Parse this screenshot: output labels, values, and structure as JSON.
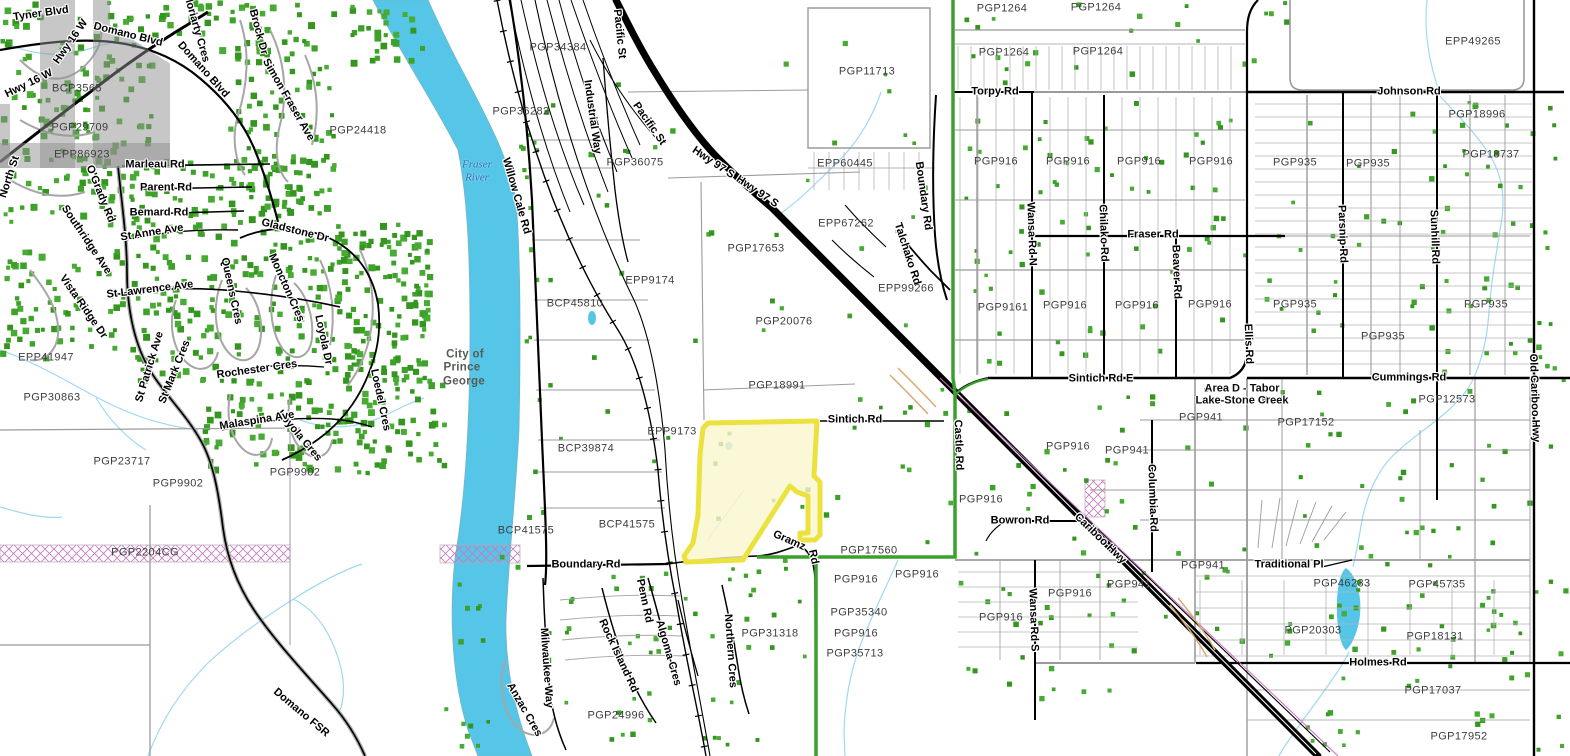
{
  "map": {
    "description": "Cadastral parcel web map, Prince George BC area",
    "colors": {
      "background": "#ffffff",
      "river": "#55c5e8",
      "creek": "#9ed9f2",
      "parcel_line": "#9b9b9b",
      "road_black": "#000000",
      "highway": "#000000",
      "green_boundary": "#3aa12c",
      "structure_dot": "#3ea22a",
      "highlight_fill": "#faf6cd",
      "highlight_stroke": "#ece23f",
      "hatch_pink": "#c87cc0",
      "label_plan": "#3d3d3d",
      "label_water": "#2e6fb0"
    },
    "labels": [
      {
        "t": "Tyner Blvd",
        "x": 41,
        "y": 14,
        "r": -8,
        "k": "road"
      },
      {
        "t": "Hwy 16 W",
        "x": 29,
        "y": 84,
        "r": -26,
        "k": "road"
      },
      {
        "t": "Hwy 16 W",
        "x": 71,
        "y": 42,
        "r": -55,
        "k": "road"
      },
      {
        "t": "Domano Blvd",
        "x": 128,
        "y": 35,
        "r": 14,
        "k": "road"
      },
      {
        "t": "Domano Blvd",
        "x": 203,
        "y": 70,
        "r": 48,
        "k": "road"
      },
      {
        "t": "Moriarty Cres",
        "x": 196,
        "y": 28,
        "r": 74,
        "k": "road"
      },
      {
        "t": "Brock Dr",
        "x": 258,
        "y": 32,
        "r": 75,
        "k": "road"
      },
      {
        "t": "Simon Fraser Ave",
        "x": 288,
        "y": 100,
        "r": 60,
        "k": "road"
      },
      {
        "t": "North St",
        "x": 10,
        "y": 177,
        "r": -72,
        "k": "road"
      },
      {
        "t": "O'Grady Rd",
        "x": 100,
        "y": 194,
        "r": 68,
        "k": "road"
      },
      {
        "t": "Southridge Ave",
        "x": 86,
        "y": 240,
        "r": 56,
        "k": "road"
      },
      {
        "t": "Marleau Rd",
        "x": 155,
        "y": 165,
        "r": 0,
        "k": "road"
      },
      {
        "t": "Parent Rd",
        "x": 166,
        "y": 188,
        "r": 0,
        "k": "road"
      },
      {
        "t": "Bemard Rd",
        "x": 159,
        "y": 213,
        "r": 0,
        "k": "road"
      },
      {
        "t": "St Anne Ave",
        "x": 152,
        "y": 233,
        "r": -9,
        "k": "road"
      },
      {
        "t": "Gladstone Dr",
        "x": 295,
        "y": 231,
        "r": 14,
        "k": "road"
      },
      {
        "t": "Vista Ridge Dr",
        "x": 83,
        "y": 307,
        "r": 55,
        "k": "road"
      },
      {
        "t": "St Lawrence Ave",
        "x": 150,
        "y": 290,
        "r": -7,
        "k": "road"
      },
      {
        "t": "Queens Cres",
        "x": 231,
        "y": 291,
        "r": 78,
        "k": "road"
      },
      {
        "t": "Moncton Cres",
        "x": 286,
        "y": 288,
        "r": 66,
        "k": "road"
      },
      {
        "t": "Loyola Dr",
        "x": 323,
        "y": 340,
        "r": 78,
        "k": "road"
      },
      {
        "t": "Loyola Cres",
        "x": 299,
        "y": 436,
        "r": 50,
        "k": "road"
      },
      {
        "t": "Loedel Cres",
        "x": 380,
        "y": 400,
        "r": 78,
        "k": "road"
      },
      {
        "t": "St Patrick Ave",
        "x": 150,
        "y": 367,
        "r": -73,
        "k": "road"
      },
      {
        "t": "St Mark Cres",
        "x": 175,
        "y": 372,
        "r": -68,
        "k": "road"
      },
      {
        "t": "Rochester Cres",
        "x": 257,
        "y": 370,
        "r": -8,
        "k": "road"
      },
      {
        "t": "Malaspina Ave",
        "x": 257,
        "y": 421,
        "r": -9,
        "k": "road"
      },
      {
        "t": "Domano FSR",
        "x": 301,
        "y": 713,
        "r": 40,
        "k": "road"
      },
      {
        "t": "Willow Cale Rd",
        "x": 516,
        "y": 196,
        "r": 74,
        "k": "road"
      },
      {
        "t": "Pacific St",
        "x": 619,
        "y": 34,
        "r": 84,
        "k": "road"
      },
      {
        "t": "Industrial Way",
        "x": 592,
        "y": 117,
        "r": 82,
        "k": "road"
      },
      {
        "t": "Pacific St",
        "x": 649,
        "y": 124,
        "r": 55,
        "k": "road"
      },
      {
        "t": "Hwy 97 S",
        "x": 713,
        "y": 163,
        "r": 34,
        "k": "road"
      },
      {
        "t": "Hwy 97 S",
        "x": 757,
        "y": 192,
        "r": 34,
        "k": "road"
      },
      {
        "t": "Torpy Rd",
        "x": 995,
        "y": 92,
        "r": 0,
        "k": "road"
      },
      {
        "t": "Boundary Rd",
        "x": 923,
        "y": 196,
        "r": 82,
        "k": "road"
      },
      {
        "t": "Talchako Rd",
        "x": 907,
        "y": 254,
        "r": 72,
        "k": "road"
      },
      {
        "t": "Sintich Rd",
        "x": 855,
        "y": 420,
        "r": 0,
        "k": "road"
      },
      {
        "t": "Sintich Rd E",
        "x": 1101,
        "y": 379,
        "r": 0,
        "k": "road"
      },
      {
        "t": "Castle Rd",
        "x": 958,
        "y": 445,
        "r": 88,
        "k": "road"
      },
      {
        "t": "Bowron Rd",
        "x": 1020,
        "y": 521,
        "r": 0,
        "k": "road"
      },
      {
        "t": "Cariboo Hwy",
        "x": 1100,
        "y": 539,
        "r": 44,
        "k": "road"
      },
      {
        "t": "Gramz",
        "x": 789,
        "y": 541,
        "r": 24,
        "k": "road"
      },
      {
        "t": "Rd",
        "x": 813,
        "y": 557,
        "r": 78,
        "k": "road"
      },
      {
        "t": "Boundary Rd",
        "x": 586,
        "y": 565,
        "r": 0,
        "k": "road"
      },
      {
        "t": "Penn Rd",
        "x": 644,
        "y": 601,
        "r": 78,
        "k": "road"
      },
      {
        "t": "Rock Island Rd",
        "x": 618,
        "y": 656,
        "r": 65,
        "k": "road"
      },
      {
        "t": "Algoma Cres",
        "x": 668,
        "y": 653,
        "r": 74,
        "k": "road"
      },
      {
        "t": "Milwaukee Way",
        "x": 546,
        "y": 668,
        "r": 86,
        "k": "road"
      },
      {
        "t": "Anzac Cres",
        "x": 524,
        "y": 710,
        "r": 60,
        "k": "road"
      },
      {
        "t": "Northern Cres",
        "x": 730,
        "y": 651,
        "r": 86,
        "k": "road"
      },
      {
        "t": "Wansa Rd N",
        "x": 1031,
        "y": 234,
        "r": 88,
        "k": "road"
      },
      {
        "t": "Chilako Rd",
        "x": 1103,
        "y": 233,
        "r": 88,
        "k": "road"
      },
      {
        "t": "Fraser Rd",
        "x": 1153,
        "y": 235,
        "r": 0,
        "k": "road"
      },
      {
        "t": "Beaver Rd",
        "x": 1176,
        "y": 272,
        "r": 88,
        "k": "road"
      },
      {
        "t": "Parsnip Rd",
        "x": 1342,
        "y": 234,
        "r": 88,
        "k": "road"
      },
      {
        "t": "Sunhill Rd",
        "x": 1434,
        "y": 237,
        "r": 88,
        "k": "road"
      },
      {
        "t": "Johnson Rd",
        "x": 1409,
        "y": 92,
        "r": 0,
        "k": "road"
      },
      {
        "t": "Ellis Rd",
        "x": 1248,
        "y": 344,
        "r": 88,
        "k": "road"
      },
      {
        "t": "Cummings Rd",
        "x": 1409,
        "y": 378,
        "r": 0,
        "k": "road"
      },
      {
        "t": "Old Cariboo Hwy",
        "x": 1534,
        "y": 398,
        "r": 88,
        "k": "road"
      },
      {
        "t": "Columbia Rd",
        "x": 1152,
        "y": 498,
        "r": 88,
        "k": "road"
      },
      {
        "t": "Wansa Rd S",
        "x": 1033,
        "y": 620,
        "r": 88,
        "k": "road"
      },
      {
        "t": "Traditional Pl",
        "x": 1289,
        "y": 565,
        "r": 0,
        "k": "road"
      },
      {
        "t": "Holmes Rd",
        "x": 1378,
        "y": 663,
        "r": 0,
        "k": "road"
      },
      {
        "t": "Fraser",
        "x": 477,
        "y": 165,
        "r": 0,
        "k": "water"
      },
      {
        "t": "River",
        "x": 477,
        "y": 178,
        "r": 0,
        "k": "water"
      },
      {
        "t": "City of",
        "x": 465,
        "y": 355,
        "r": 0,
        "k": "city"
      },
      {
        "t": "Prince",
        "x": 462,
        "y": 368,
        "r": 0,
        "k": "city"
      },
      {
        "t": "George",
        "x": 464,
        "y": 382,
        "r": 0,
        "k": "city"
      },
      {
        "t": "Area D - Tabor",
        "x": 1242,
        "y": 389,
        "r": 0,
        "k": "area"
      },
      {
        "t": "Lake-Stone Creek",
        "x": 1242,
        "y": 401,
        "r": 0,
        "k": "area"
      },
      {
        "t": "BCP3565",
        "x": 77,
        "y": 89,
        "r": 0,
        "k": "plan"
      },
      {
        "t": "PGP29709",
        "x": 80,
        "y": 128,
        "r": 0,
        "k": "plan"
      },
      {
        "t": "EPP86923",
        "x": 82,
        "y": 155,
        "r": 0,
        "k": "plan"
      },
      {
        "t": "PGP24418",
        "x": 358,
        "y": 131,
        "r": 0,
        "k": "plan"
      },
      {
        "t": "EPP41947",
        "x": 46,
        "y": 358,
        "r": 0,
        "k": "plan"
      },
      {
        "t": "PGP30863",
        "x": 52,
        "y": 398,
        "r": 0,
        "k": "plan"
      },
      {
        "t": "PGP23717",
        "x": 122,
        "y": 462,
        "r": 0,
        "k": "plan"
      },
      {
        "t": "PGP9902",
        "x": 178,
        "y": 484,
        "r": 0,
        "k": "plan"
      },
      {
        "t": "PGP9902",
        "x": 295,
        "y": 473,
        "r": 0,
        "k": "plan"
      },
      {
        "t": "PGP2204CG",
        "x": 145,
        "y": 553,
        "r": 0,
        "k": "plan"
      },
      {
        "t": "PGP34384",
        "x": 558,
        "y": 48,
        "r": 0,
        "k": "plan"
      },
      {
        "t": "PGP36282",
        "x": 521,
        "y": 112,
        "r": 0,
        "k": "plan"
      },
      {
        "t": "PGP36075",
        "x": 635,
        "y": 163,
        "r": 0,
        "k": "plan"
      },
      {
        "t": "PGP11713",
        "x": 867,
        "y": 72,
        "r": 0,
        "k": "plan"
      },
      {
        "t": "EPP60445",
        "x": 845,
        "y": 164,
        "r": 0,
        "k": "plan"
      },
      {
        "t": "EPP67262",
        "x": 846,
        "y": 224,
        "r": 0,
        "k": "plan"
      },
      {
        "t": "PGP17653",
        "x": 756,
        "y": 249,
        "r": 0,
        "k": "plan"
      },
      {
        "t": "EPP99266",
        "x": 906,
        "y": 289,
        "r": 0,
        "k": "plan"
      },
      {
        "t": "PGP20076",
        "x": 784,
        "y": 322,
        "r": 0,
        "k": "plan"
      },
      {
        "t": "PGP18991",
        "x": 777,
        "y": 386,
        "r": 0,
        "k": "plan"
      },
      {
        "t": "EPP9174",
        "x": 650,
        "y": 281,
        "r": 0,
        "k": "plan"
      },
      {
        "t": "BCP45810",
        "x": 575,
        "y": 304,
        "r": 0,
        "k": "plan"
      },
      {
        "t": "EPP9173",
        "x": 672,
        "y": 432,
        "r": 0,
        "k": "plan"
      },
      {
        "t": "BCP39874",
        "x": 586,
        "y": 449,
        "r": 0,
        "k": "plan"
      },
      {
        "t": "BCP41575",
        "x": 526,
        "y": 531,
        "r": 0,
        "k": "plan"
      },
      {
        "t": "BCP41575",
        "x": 627,
        "y": 525,
        "r": 0,
        "k": "plan"
      },
      {
        "t": "PGP24996",
        "x": 616,
        "y": 716,
        "r": 0,
        "k": "plan"
      },
      {
        "t": "PGP31318",
        "x": 770,
        "y": 634,
        "r": 0,
        "k": "plan"
      },
      {
        "t": "PGP17560",
        "x": 869,
        "y": 551,
        "r": 0,
        "k": "plan"
      },
      {
        "t": "PGP1264",
        "x": 1002,
        "y": 9,
        "r": 0,
        "k": "plan"
      },
      {
        "t": "PGP1264",
        "x": 1096,
        "y": 8,
        "r": 0,
        "k": "plan"
      },
      {
        "t": "PGP1264",
        "x": 1004,
        "y": 53,
        "r": 0,
        "k": "plan"
      },
      {
        "t": "PGP1264",
        "x": 1098,
        "y": 52,
        "r": 0,
        "k": "plan"
      },
      {
        "t": "EPP49265",
        "x": 1473,
        "y": 42,
        "r": 0,
        "k": "plan"
      },
      {
        "t": "PGP18996",
        "x": 1477,
        "y": 115,
        "r": 0,
        "k": "plan"
      },
      {
        "t": "PGP18737",
        "x": 1491,
        "y": 155,
        "r": 0,
        "k": "plan"
      },
      {
        "t": "PGP935",
        "x": 1295,
        "y": 163,
        "r": 0,
        "k": "plan"
      },
      {
        "t": "PGP935",
        "x": 1368,
        "y": 164,
        "r": 0,
        "k": "plan"
      },
      {
        "t": "PGP916",
        "x": 996,
        "y": 162,
        "r": 0,
        "k": "plan"
      },
      {
        "t": "PGP916",
        "x": 1068,
        "y": 162,
        "r": 0,
        "k": "plan"
      },
      {
        "t": "PGP916",
        "x": 1139,
        "y": 162,
        "r": 0,
        "k": "plan"
      },
      {
        "t": "PGP916",
        "x": 1211,
        "y": 162,
        "r": 0,
        "k": "plan"
      },
      {
        "t": "PGP9161",
        "x": 1003,
        "y": 308,
        "r": 0,
        "k": "plan"
      },
      {
        "t": "PGP916",
        "x": 1065,
        "y": 306,
        "r": 0,
        "k": "plan"
      },
      {
        "t": "PGP916",
        "x": 1137,
        "y": 306,
        "r": 0,
        "k": "plan"
      },
      {
        "t": "PGP916",
        "x": 1210,
        "y": 305,
        "r": 0,
        "k": "plan"
      },
      {
        "t": "PGP935",
        "x": 1295,
        "y": 305,
        "r": 0,
        "k": "plan"
      },
      {
        "t": "PGP935",
        "x": 1486,
        "y": 305,
        "r": 0,
        "k": "plan"
      },
      {
        "t": "PGP935",
        "x": 1383,
        "y": 337,
        "r": 0,
        "k": "plan"
      },
      {
        "t": "PGP12573",
        "x": 1447,
        "y": 400,
        "r": 0,
        "k": "plan"
      },
      {
        "t": "PGP17152",
        "x": 1306,
        "y": 423,
        "r": 0,
        "k": "plan"
      },
      {
        "t": "PGP941",
        "x": 1201,
        "y": 418,
        "r": 0,
        "k": "plan"
      },
      {
        "t": "PGP941",
        "x": 1127,
        "y": 451,
        "r": 0,
        "k": "plan"
      },
      {
        "t": "PGP916",
        "x": 1068,
        "y": 447,
        "r": 0,
        "k": "plan"
      },
      {
        "t": "PGP916",
        "x": 981,
        "y": 500,
        "r": 0,
        "k": "plan"
      },
      {
        "t": "PGP916",
        "x": 917,
        "y": 575,
        "r": 0,
        "k": "plan"
      },
      {
        "t": "PGP916",
        "x": 856,
        "y": 580,
        "r": 0,
        "k": "plan"
      },
      {
        "t": "PGP35340",
        "x": 859,
        "y": 613,
        "r": 0,
        "k": "plan"
      },
      {
        "t": "PGP916",
        "x": 856,
        "y": 634,
        "r": 0,
        "k": "plan"
      },
      {
        "t": "PGP35713",
        "x": 855,
        "y": 654,
        "r": 0,
        "k": "plan"
      },
      {
        "t": "PGP916",
        "x": 1001,
        "y": 618,
        "r": 0,
        "k": "plan"
      },
      {
        "t": "PGP916",
        "x": 1070,
        "y": 594,
        "r": 0,
        "k": "plan"
      },
      {
        "t": "PGP941",
        "x": 1203,
        "y": 566,
        "r": 0,
        "k": "plan"
      },
      {
        "t": "PGP941",
        "x": 1129,
        "y": 585,
        "r": 0,
        "k": "plan"
      },
      {
        "t": "PGP46233",
        "x": 1342,
        "y": 584,
        "r": 0,
        "k": "plan"
      },
      {
        "t": "PGP45735",
        "x": 1437,
        "y": 585,
        "r": 0,
        "k": "plan"
      },
      {
        "t": "PGP20303",
        "x": 1313,
        "y": 631,
        "r": 0,
        "k": "plan"
      },
      {
        "t": "PGP18131",
        "x": 1435,
        "y": 637,
        "r": 0,
        "k": "plan"
      },
      {
        "t": "PGP17037",
        "x": 1433,
        "y": 691,
        "r": 0,
        "k": "plan"
      },
      {
        "t": "PGP17952",
        "x": 1459,
        "y": 737,
        "r": 0,
        "k": "plan"
      }
    ],
    "structure_dot_clusters": [
      [
        960,
        100,
        285,
        268,
        68
      ],
      [
        1255,
        100,
        300,
        268,
        52
      ],
      [
        958,
        385,
        185,
        168,
        22
      ],
      [
        1150,
        385,
        400,
        268,
        70
      ],
      [
        955,
        562,
        195,
        145,
        26
      ],
      [
        1250,
        555,
        320,
        195,
        42
      ],
      [
        520,
        40,
        210,
        480,
        26
      ],
      [
        600,
        555,
        170,
        195,
        34
      ],
      [
        440,
        545,
        135,
        200,
        22
      ],
      [
        745,
        40,
        190,
        290,
        18
      ],
      [
        820,
        380,
        130,
        180,
        14
      ],
      [
        955,
        0,
        290,
        90,
        18
      ],
      [
        1440,
        90,
        130,
        290,
        20
      ],
      [
        690,
        560,
        120,
        100,
        12
      ],
      [
        515,
        90,
        40,
        430,
        12
      ],
      [
        700,
        420,
        120,
        140,
        8
      ],
      [
        1250,
        0,
        60,
        90,
        5
      ]
    ],
    "house_clusters": [
      [
        0,
        0,
        150,
        225,
        150
      ],
      [
        150,
        0,
        120,
        60,
        36
      ],
      [
        228,
        0,
        105,
        215,
        100
      ],
      [
        0,
        248,
        122,
        108,
        62
      ],
      [
        128,
        222,
        300,
        160,
        230
      ],
      [
        198,
        378,
        245,
        95,
        130
      ],
      [
        128,
        158,
        180,
        68,
        70
      ],
      [
        330,
        230,
        100,
        150,
        70
      ],
      [
        335,
        0,
        90,
        60,
        28
      ]
    ]
  }
}
